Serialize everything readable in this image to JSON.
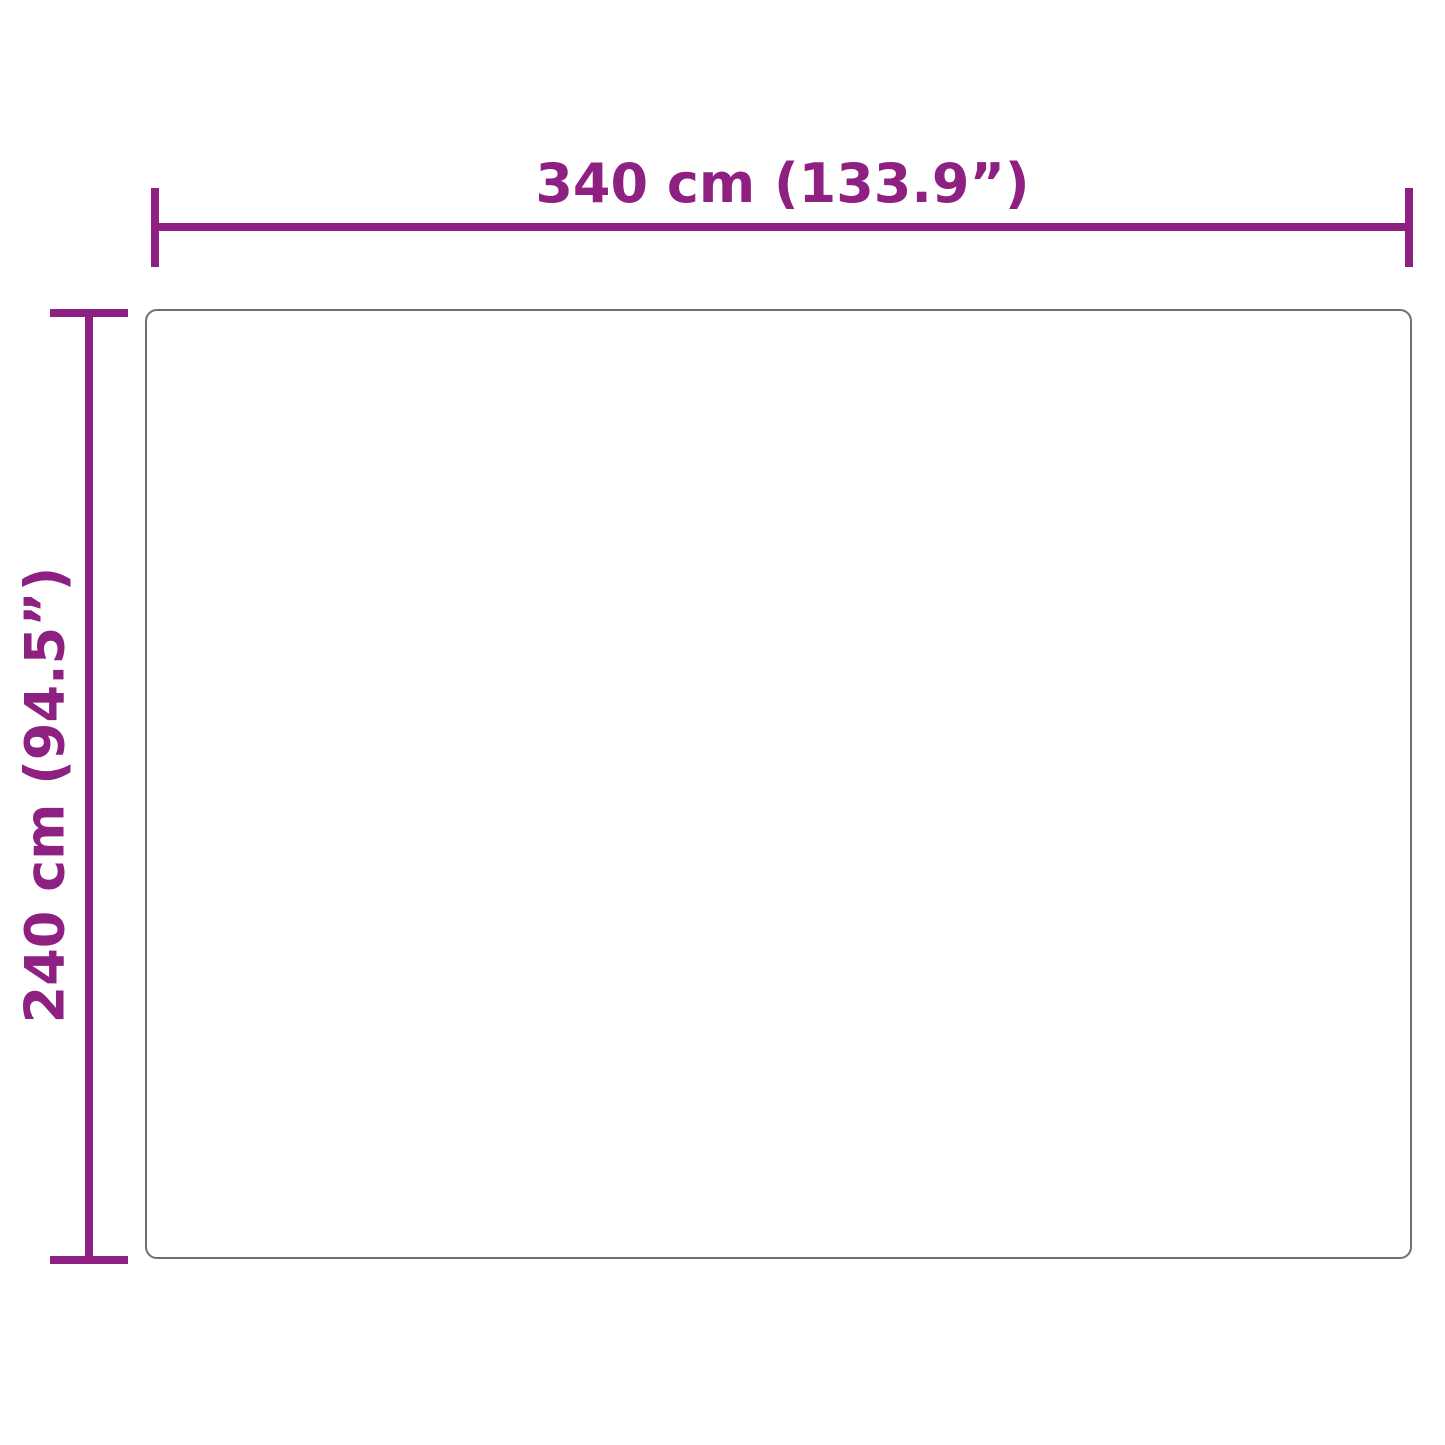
{
  "diagram": {
    "type": "product-dimension-diagram",
    "width_label": "340 cm (133.9”)",
    "height_label": "240 cm (94.5”)",
    "width_cm": 340,
    "width_inches": 133.9,
    "height_cm": 240,
    "height_inches": 94.5
  },
  "colors": {
    "dimension_accent": "#8e2081",
    "outline_gray": "#6f6f6f",
    "background": "#ffffff"
  }
}
